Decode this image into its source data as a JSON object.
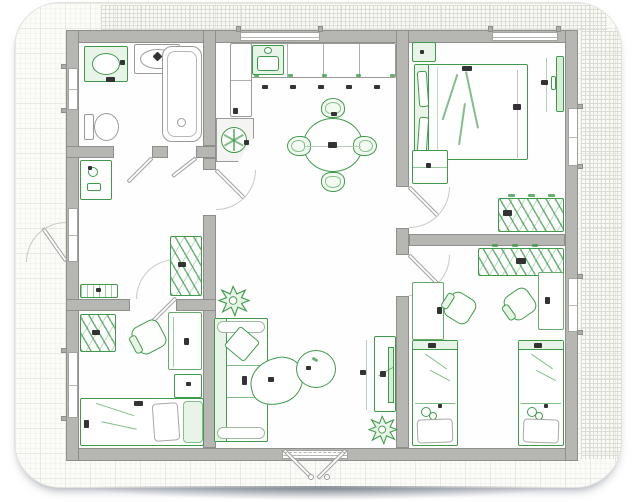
{
  "plan": {
    "colors": {
      "wall": "#b6b6b3",
      "wallb": "#8e8e8b",
      "green": "#3f9b4b",
      "greenlt": "#e9f4e9",
      "fix": "#9a9a97",
      "mk": "#333333",
      "paper": "#fbfbf8",
      "grid": "#e9e9e4",
      "gridd": "#d6d6d0",
      "shadow": "#97a0ac"
    },
    "rooms": [
      {
        "id": "bathroom",
        "furniture": [
          "washing-machine",
          "washbasin",
          "bathtub",
          "toilet"
        ]
      },
      {
        "id": "kitchen-dining",
        "furniture": [
          "counter-cabinets",
          "kitchen-sink",
          "corner-carousel-unit",
          "round-dining-table",
          "dining-chair-x4"
        ]
      },
      {
        "id": "master-bedroom",
        "furniture": [
          "double-bed",
          "pillows",
          "nightstand",
          "chest-of-drawers",
          "wall-tv",
          "wardrobe-with-hangers"
        ]
      },
      {
        "id": "hallway",
        "furniture": [
          "console-cabinet",
          "wardrobe-with-hangers",
          "shoe-bench"
        ]
      },
      {
        "id": "kids-bedroom-left",
        "furniture": [
          "wardrobe",
          "desk",
          "office-chair",
          "drawer-unit",
          "single-bed"
        ]
      },
      {
        "id": "living-room",
        "furniture": [
          "sofa",
          "throw-pillow",
          "organic-coffee-table-x2",
          "tv-stand",
          "potted-plant-x2"
        ]
      },
      {
        "id": "kids-bedroom-right",
        "furniture": [
          "wardrobe-with-hangers",
          "desk-x2",
          "office-chair-x2",
          "single-bed-x2",
          "teddy-bear-x2"
        ]
      }
    ],
    "openings": {
      "windows": 7,
      "interior_doors": 5,
      "entry_doors": [
        "left-side-single",
        "bottom-double"
      ]
    }
  }
}
